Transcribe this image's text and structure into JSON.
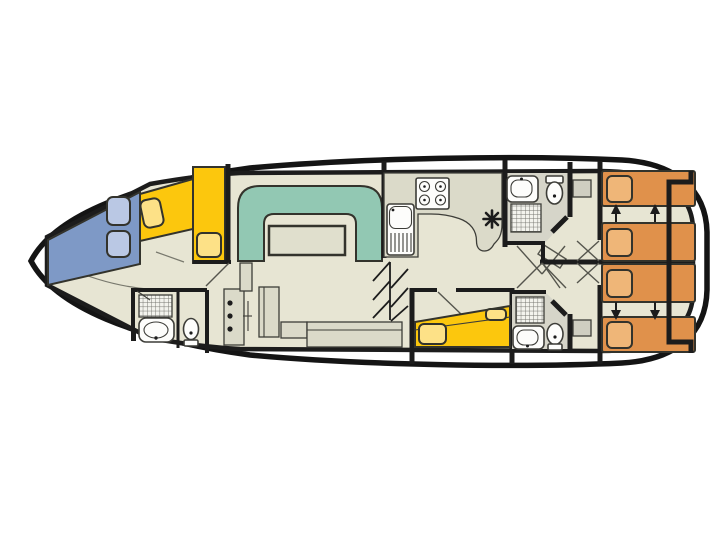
{
  "page": {
    "background": "#ffffff",
    "content": "houseboat-deck-plan"
  },
  "palette": {
    "page_bg": "#ffffff",
    "hull_line": "#141414",
    "wall": "#1c1c1c",
    "floor": "#e7e5d3",
    "wet_floor": "#d6d5c9",
    "furniture": "#dbdac9",
    "wardrobe": "#cfcec1",
    "table": "#e0dfcd",
    "fixture_fill": "#fdfdfb",
    "fixture_line": "#3d3d38",
    "door_line": "#55554d",
    "floor_line": "#78786d",
    "outline_dark": "#33332c",
    "bed_blue": "#7e99c6",
    "pillow_blue": "#bac8e4",
    "bed_yellow": "#fcc70d",
    "pillow_yellow": "#fde187",
    "sofa_teal": "#92c8b3",
    "bed_orange": "#e0914b",
    "pillow_orange": "#efb678"
  },
  "inventory": {
    "berths": {
      "bow_double_blue": 1,
      "bow_single_yellow": 2,
      "mid_double_yellow": 1,
      "aft_single_orange": 4
    },
    "pillows": {
      "blue": 2,
      "yellow": 3,
      "orange": 4
    },
    "bathrooms": 3,
    "toilets": 3,
    "bathroom_sinks": 3,
    "showers": 3,
    "galley": {
      "hob_burners": 4,
      "sink_with_drainer": 1
    },
    "salon": {
      "u_sofa": 1,
      "table": 1,
      "bench": 1,
      "cabinet": 1
    },
    "helm_console_knobs": 3,
    "bed_slide_arrows": 4,
    "heater_marker": 1,
    "wardrobes": 2,
    "companionway_steps": 1
  }
}
